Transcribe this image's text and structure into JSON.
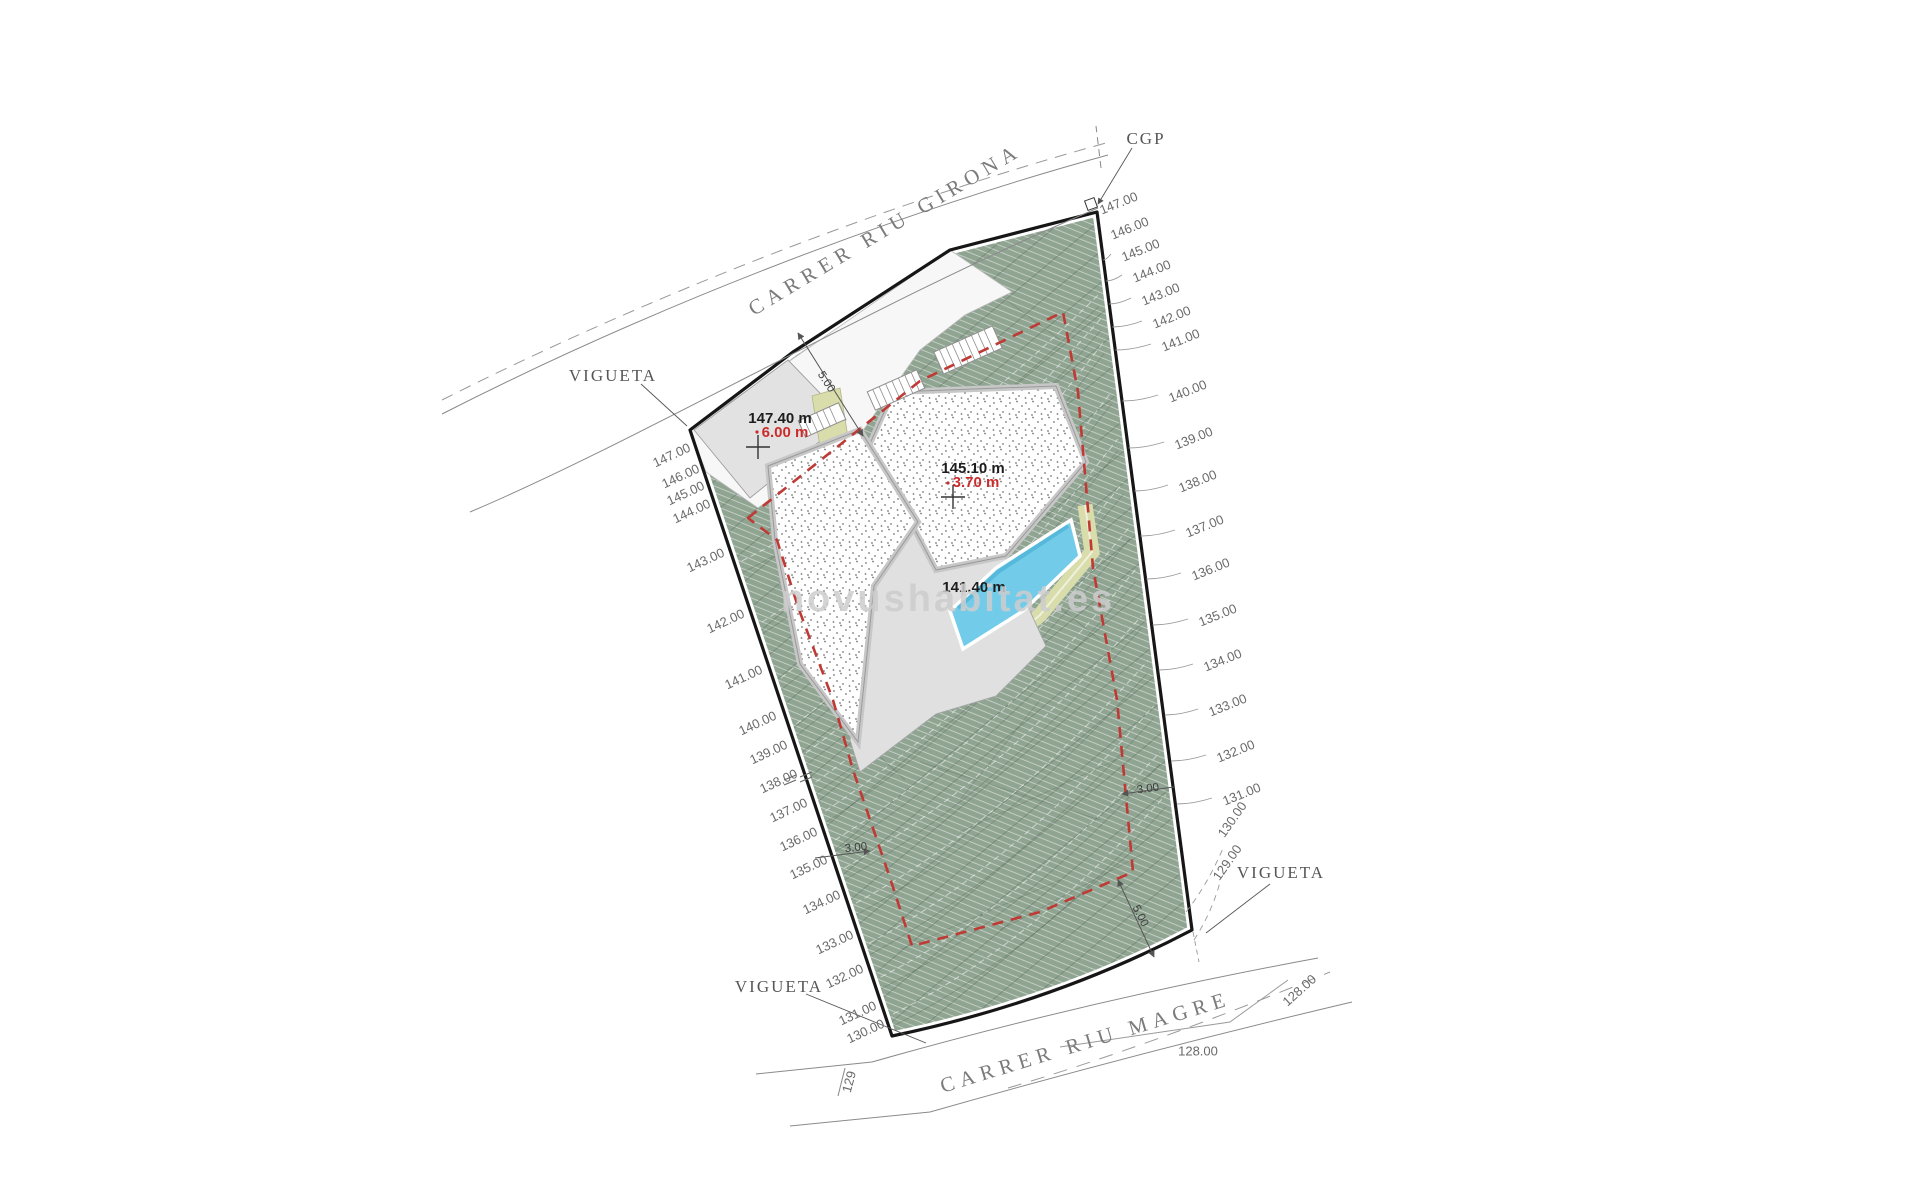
{
  "drawing_type": "architectural site plan",
  "watermark": {
    "text": "novushabitat.es"
  },
  "streets": [
    {
      "name": "CARRER RIU GIRONA",
      "x": 886,
      "y": 231,
      "rot": -31
    },
    {
      "name": "CARRER RIU MAGRE",
      "x": 1086,
      "y": 1044,
      "rot": -17
    }
  ],
  "point_labels": [
    {
      "text": "CGP",
      "x": 1146,
      "y": 140
    },
    {
      "text": "VIGUETA",
      "x": 613,
      "y": 377
    },
    {
      "text": "VIGUETA",
      "x": 1281,
      "y": 874
    },
    {
      "text": "VIGUETA",
      "x": 779,
      "y": 988
    }
  ],
  "contour_labels_left": [
    {
      "text": "147.00",
      "x": 672,
      "y": 456
    },
    {
      "text": "146.00",
      "x": 681,
      "y": 477
    },
    {
      "text": "145.00",
      "x": 686,
      "y": 494
    },
    {
      "text": "144.00",
      "x": 692,
      "y": 512
    },
    {
      "text": "143.00",
      "x": 706,
      "y": 561
    },
    {
      "text": "142.00",
      "x": 726,
      "y": 622
    },
    {
      "text": "141.00",
      "x": 744,
      "y": 678
    },
    {
      "text": "140.00",
      "x": 758,
      "y": 724
    },
    {
      "text": "139.00",
      "x": 769,
      "y": 753
    },
    {
      "text": "138.00",
      "x": 779,
      "y": 782
    },
    {
      "text": "137.00",
      "x": 789,
      "y": 811
    },
    {
      "text": "136.00",
      "x": 799,
      "y": 840
    },
    {
      "text": "135.00",
      "x": 809,
      "y": 868
    },
    {
      "text": "134.00",
      "x": 822,
      "y": 903
    },
    {
      "text": "133.00",
      "x": 835,
      "y": 943
    },
    {
      "text": "132.00",
      "x": 845,
      "y": 977
    },
    {
      "text": "131.00",
      "x": 858,
      "y": 1014
    },
    {
      "text": "130.00",
      "x": 866,
      "y": 1032
    },
    {
      "text": "129",
      "x": 850,
      "y": 1082,
      "rot": -75
    }
  ],
  "contour_labels_right": [
    {
      "text": "147.00",
      "x": 1119,
      "y": 204
    },
    {
      "text": "146.00",
      "x": 1130,
      "y": 229
    },
    {
      "text": "145.00",
      "x": 1141,
      "y": 251
    },
    {
      "text": "144.00",
      "x": 1152,
      "y": 272
    },
    {
      "text": "143.00",
      "x": 1161,
      "y": 295
    },
    {
      "text": "142.00",
      "x": 1172,
      "y": 318
    },
    {
      "text": "141.00",
      "x": 1181,
      "y": 341
    },
    {
      "text": "140.00",
      "x": 1188,
      "y": 392
    },
    {
      "text": "139.00",
      "x": 1194,
      "y": 439
    },
    {
      "text": "138.00",
      "x": 1198,
      "y": 482
    },
    {
      "text": "137.00",
      "x": 1205,
      "y": 527
    },
    {
      "text": "136.00",
      "x": 1211,
      "y": 570
    },
    {
      "text": "135.00",
      "x": 1218,
      "y": 616
    },
    {
      "text": "134.00",
      "x": 1223,
      "y": 661
    },
    {
      "text": "133.00",
      "x": 1228,
      "y": 706
    },
    {
      "text": "132.00",
      "x": 1236,
      "y": 752
    },
    {
      "text": "131.00",
      "x": 1242,
      "y": 795
    },
    {
      "text": "130.00",
      "x": 1233,
      "y": 820,
      "rot": -55
    },
    {
      "text": "129.00",
      "x": 1228,
      "y": 863,
      "rot": -55
    },
    {
      "text": "128.00",
      "x": 1300,
      "y": 991,
      "rot": -42
    },
    {
      "text": "128.00",
      "x": 1198,
      "y": 1052,
      "rot": 0
    }
  ],
  "building": {
    "annotations": [
      {
        "text": "147.40 m",
        "x": 780,
        "y": 419,
        "red": false
      },
      {
        "text": "6.00 m",
        "x": 785,
        "y": 433,
        "red": true
      },
      {
        "text": "145.10 m",
        "x": 973,
        "y": 469,
        "red": false
      },
      {
        "text": "3.70 m",
        "x": 976,
        "y": 483,
        "red": true
      },
      {
        "text": "141.40 m",
        "x": 974,
        "y": 588,
        "red": false
      }
    ]
  },
  "dimensions": [
    {
      "text": "5.00",
      "x": 826,
      "y": 382,
      "rot": 57
    },
    {
      "text": "3.00",
      "x": 856,
      "y": 848,
      "rot": -6
    },
    {
      "text": "3.00",
      "x": 1148,
      "y": 789,
      "rot": -8
    },
    {
      "text": "5.00",
      "x": 1140,
      "y": 916,
      "rot": 63
    }
  ],
  "colors": {
    "terrain_green": "#90a492",
    "pool_blue": "#72cce9",
    "path_khaki": "#d9dcab",
    "setback_red": "#bf3a35",
    "boundary_black": "#161616",
    "terrace_gray": "#e2e2e2"
  }
}
